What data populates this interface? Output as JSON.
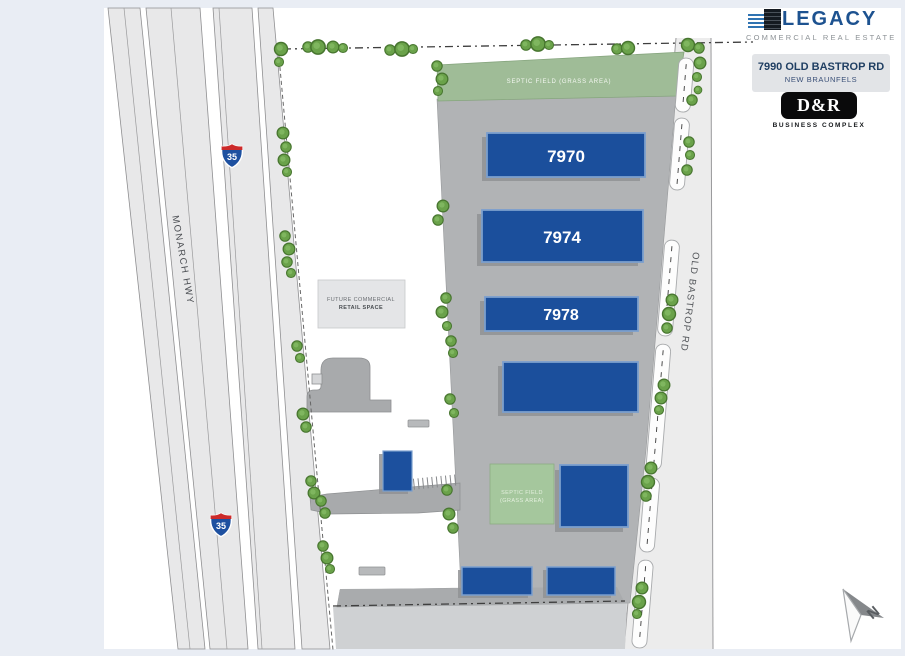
{
  "branding": {
    "legacy_name": "LEGACY",
    "legacy_tagline": "COMMERCIAL REAL ESTATE",
    "address_line1": "7990 OLD BASTROP RD",
    "address_line2": "NEW BRAUNFELS",
    "dr_name": "D&R",
    "dr_tagline": "BUSINESS COMPLEX"
  },
  "plan": {
    "monarch_label": "MONARCH HWY",
    "interstate_shield": "35",
    "old_bastrop_label": "OLD BASTROP RD",
    "septic_strip_label": "SEPTIC FIELD (GRASS AREA)",
    "septic_square_line1": "SEPTIC FIELD",
    "septic_square_line2": "(GRASS AREA)",
    "future_retail_line1": "FUTURE COMMERCIAL",
    "future_retail_line2": "RETAIL SPACE",
    "buildings": [
      "7970",
      "7974",
      "7978"
    ],
    "compass_n": "N"
  },
  "colors": {
    "building_blue": "#1b4f9c",
    "septic_green": "#9fbc97",
    "tree_green": "#6aa24a",
    "brand_blue": "#1d5290",
    "lot_gray": "#b1b3b5",
    "road_gray": "#ececec",
    "page_background": "#e9edf4"
  }
}
